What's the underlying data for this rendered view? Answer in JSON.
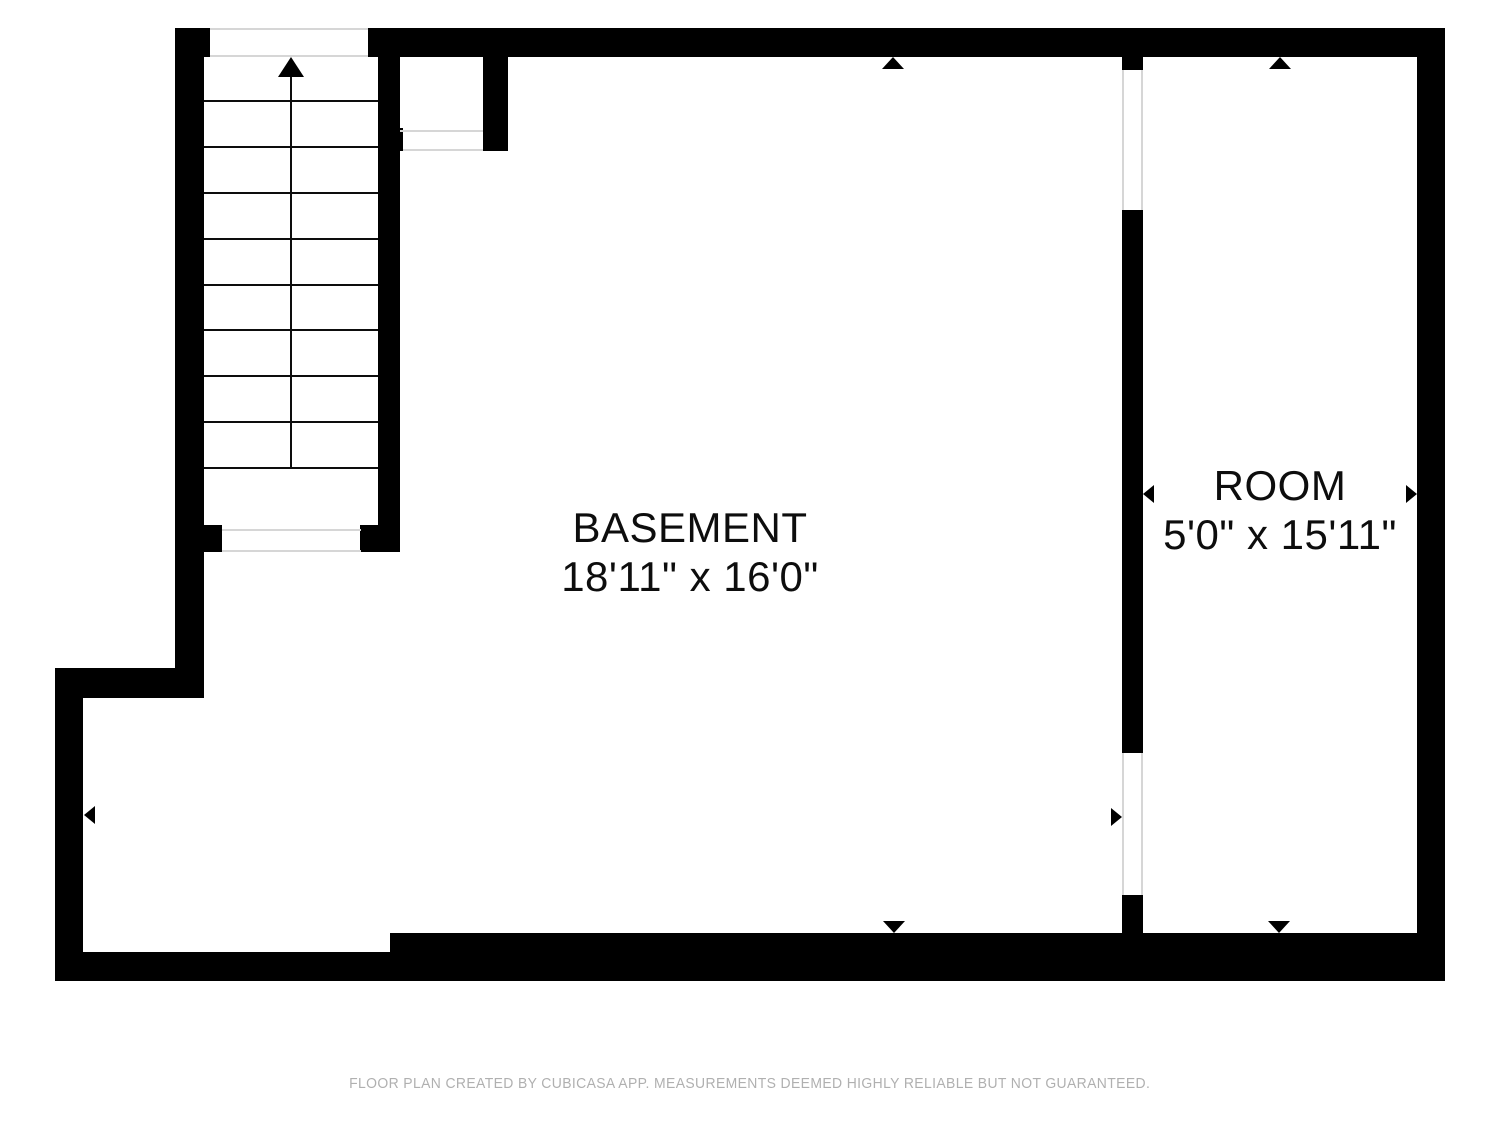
{
  "rooms": [
    {
      "name": "BASEMENT",
      "dimensions": "18'11\" x 16'0\""
    },
    {
      "name": "ROOM",
      "dimensions": "5'0\" x 15'11\""
    }
  ],
  "stairs": {
    "tread_count": 9,
    "direction": "up"
  },
  "markers": {
    "dimension_arrow_shape": "small black triangle",
    "stairs_direction_shape": "up arrow with stem"
  },
  "colors": {
    "background": "#ffffff",
    "wall": "#000000",
    "opening_line": "#d6d6d6",
    "stair_line": "#0d0d0d",
    "label_text": "#0d0d0d",
    "footer_text": "#b0b0b0"
  },
  "footer": {
    "disclaimer": "FLOOR PLAN CREATED BY CUBICASA APP. MEASUREMENTS DEEMED HIGHLY RELIABLE BUT NOT GUARANTEED."
  }
}
